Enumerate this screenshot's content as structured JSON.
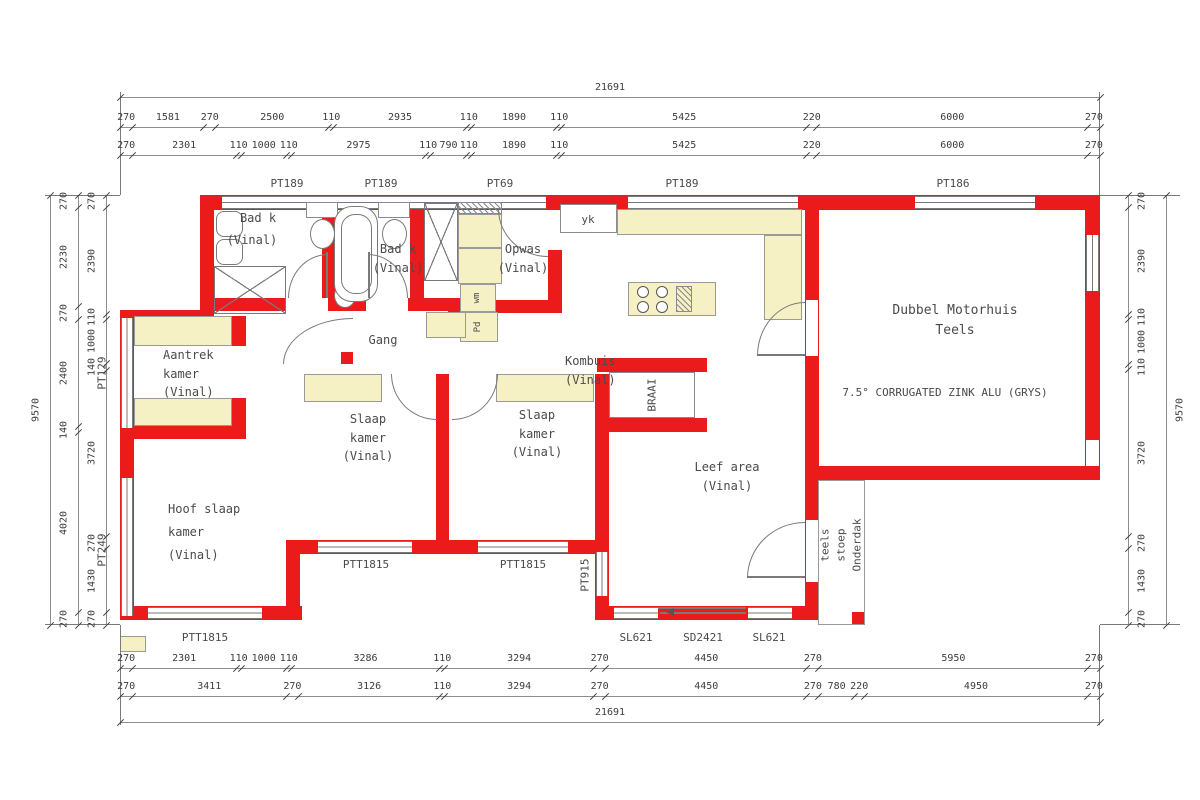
{
  "meta": {
    "drawing_type": "house floor plan"
  },
  "colors": {
    "wall": "#ec1b1b",
    "cupboard": "#f6f1c5",
    "line": "#7a7a7a",
    "text": "#4a4a4a"
  },
  "texts": {
    "garage_title": [
      "Dubbel Motorhuis",
      "Teels"
    ],
    "roof_note": "7.5° CORRUGATED ZINK ALU (GRYS)",
    "stoep": [
      "Onderdak",
      "stoep",
      "teels"
    ]
  },
  "dimensions": {
    "top": {
      "overall": 21691,
      "row_a": [
        270,
        1581,
        270,
        2500,
        110,
        2935,
        110,
        1890,
        110,
        5425,
        220,
        6000,
        270
      ],
      "row_b": [
        270,
        2301,
        110,
        1000,
        110,
        2975,
        110,
        790,
        110,
        1890,
        110,
        5425,
        220,
        6000,
        270
      ]
    },
    "bottom": {
      "row_a": [
        270,
        2301,
        110,
        1000,
        110,
        3286,
        110,
        3294,
        270,
        4450,
        270,
        5950,
        270
      ],
      "row_b": [
        270,
        3411,
        270,
        3126,
        110,
        3294,
        270,
        4450,
        270,
        780,
        220,
        4950,
        270
      ],
      "overall": 21691
    },
    "left": {
      "overall": 9570,
      "outer": [
        270,
        2230,
        270,
        2400,
        140,
        4020,
        270
      ],
      "inner": [
        270,
        2390,
        110,
        1000,
        140,
        3720,
        270,
        1430,
        270
      ]
    },
    "right": {
      "overall": 9570,
      "col": [
        270,
        2390,
        110,
        1000,
        110,
        3720,
        270,
        1430,
        270
      ]
    }
  },
  "labels": [
    {
      "n": "room-label-bad-k-1",
      "t": [
        "Bad k"
      ],
      "x": 258,
      "y": 209,
      "a": "c"
    },
    {
      "n": "room-label-bad-k-1-floor",
      "t": [
        "(Vinal)"
      ],
      "x": 252,
      "y": 231,
      "a": "c"
    },
    {
      "n": "room-label-bad-k-2",
      "t": [
        "Bad k",
        "(Vinal)"
      ],
      "x": 398,
      "y": 240,
      "a": "c"
    },
    {
      "n": "room-label-opwas",
      "t": [
        "Opwas",
        "(Vinal)"
      ],
      "x": 523,
      "y": 240,
      "a": "c"
    },
    {
      "n": "appliance-label-yk",
      "t": [
        "yk"
      ],
      "x": 588,
      "y": 211,
      "a": "c",
      "s": 11
    },
    {
      "n": "room-label-gang",
      "t": [
        "Gang"
      ],
      "x": 383,
      "y": 331,
      "a": "c"
    },
    {
      "n": "room-label-aantrek",
      "t": [
        "Aantrek",
        "kamer",
        "(Vinal)"
      ],
      "x": 163,
      "y": 346,
      "a": "l"
    },
    {
      "n": "room-label-hoof-slaap",
      "t": [
        "Hoof slaap",
        "kamer",
        "(Vinal)"
      ],
      "x": 168,
      "y": 498,
      "a": "l",
      "lh": 1.9
    },
    {
      "n": "room-label-slaap-2",
      "t": [
        "Slaap",
        "kamer",
        "(Vinal)"
      ],
      "x": 368,
      "y": 410,
      "a": "c"
    },
    {
      "n": "room-label-slaap-3",
      "t": [
        "Slaap",
        "kamer",
        "(Vinal)"
      ],
      "x": 537,
      "y": 406,
      "a": "c"
    },
    {
      "n": "room-label-kombuis",
      "t": [
        "Kombuis",
        "(Vinal)"
      ],
      "x": 565,
      "y": 352,
      "a": "l"
    },
    {
      "n": "room-label-leef-area",
      "t": [
        "Leef area",
        "(Vinal)"
      ],
      "x": 727,
      "y": 458,
      "a": "c"
    },
    {
      "n": "room-label-garage",
      "t": [
        "Dubbel Motorhuis",
        "Teels"
      ],
      "x": 955,
      "y": 301,
      "a": "c",
      "s": 13
    },
    {
      "n": "roof-note",
      "t": [
        "7.5° CORRUGATED ZINK ALU (GRYS)"
      ],
      "x": 945,
      "y": 384,
      "a": "c",
      "s": 11
    },
    {
      "n": "fixture-label-braai",
      "t": [
        "BRAAI"
      ],
      "x": 652,
      "y": 395,
      "r": 1,
      "s": 11
    },
    {
      "n": "appliance-label-wm",
      "t": [
        "wm"
      ],
      "x": 478,
      "y": 298,
      "r": 1,
      "s": 9
    },
    {
      "n": "appliance-label-pd",
      "t": [
        "Pd"
      ],
      "x": 479,
      "y": 327,
      "r": 1,
      "s": 9
    },
    {
      "n": "stoep-label-onderdak",
      "t": [
        "Onderdak"
      ],
      "x": 857,
      "y": 545,
      "r": 1,
      "s": 11
    },
    {
      "n": "stoep-label-stoep",
      "t": [
        "stoep"
      ],
      "x": 841,
      "y": 545,
      "r": 1,
      "s": 11
    },
    {
      "n": "stoep-label-teels",
      "t": [
        "teels"
      ],
      "x": 825,
      "y": 545,
      "r": 1,
      "s": 11
    },
    {
      "n": "window-label-pt189-1",
      "t": [
        "PT189"
      ],
      "x": 287,
      "y": 175,
      "a": "c",
      "s": 11
    },
    {
      "n": "window-label-pt189-2",
      "t": [
        "PT189"
      ],
      "x": 381,
      "y": 175,
      "a": "c",
      "s": 11
    },
    {
      "n": "window-label-pt69",
      "t": [
        "PT69"
      ],
      "x": 500,
      "y": 175,
      "a": "c",
      "s": 11
    },
    {
      "n": "window-label-pt189-3",
      "t": [
        "PT189"
      ],
      "x": 682,
      "y": 175,
      "a": "c",
      "s": 11
    },
    {
      "n": "window-label-pt186",
      "t": [
        "PT186"
      ],
      "x": 953,
      "y": 175,
      "a": "c",
      "s": 11
    },
    {
      "n": "window-label-pt129",
      "t": [
        "PT129"
      ],
      "x": 102,
      "y": 373,
      "r": 1,
      "s": 11
    },
    {
      "n": "window-label-pt249",
      "t": [
        "PT249"
      ],
      "x": 102,
      "y": 550,
      "r": 1,
      "s": 11
    },
    {
      "n": "window-label-pt915",
      "t": [
        "PT915"
      ],
      "x": 585,
      "y": 575,
      "r": 1,
      "s": 11
    },
    {
      "n": "window-label-ptt1815-1",
      "t": [
        "PTT1815"
      ],
      "x": 205,
      "y": 629,
      "a": "c",
      "s": 11
    },
    {
      "n": "window-label-ptt1815-2",
      "t": [
        "PTT1815"
      ],
      "x": 366,
      "y": 556,
      "a": "c",
      "s": 11
    },
    {
      "n": "window-label-ptt1815-3",
      "t": [
        "PTT1815"
      ],
      "x": 523,
      "y": 556,
      "a": "c",
      "s": 11
    },
    {
      "n": "door-label-sl621-1",
      "t": [
        "SL621"
      ],
      "x": 636,
      "y": 629,
      "a": "c",
      "s": 11
    },
    {
      "n": "door-label-sd2421",
      "t": [
        "SD2421"
      ],
      "x": 703,
      "y": 629,
      "a": "c",
      "s": 11
    },
    {
      "n": "door-label-sl621-2",
      "t": [
        "SL621"
      ],
      "x": 769,
      "y": 629,
      "a": "c",
      "s": 11
    }
  ],
  "geometry": {
    "walls": [
      [
        200,
        195,
        900,
        15
      ],
      [
        1085,
        195,
        15,
        285
      ],
      [
        818,
        466,
        282,
        14
      ],
      [
        805,
        195,
        14,
        271
      ],
      [
        805,
        466,
        14,
        154
      ],
      [
        595,
        606,
        224,
        14
      ],
      [
        595,
        540,
        14,
        80
      ],
      [
        286,
        540,
        323,
        14
      ],
      [
        286,
        540,
        14,
        80
      ],
      [
        120,
        606,
        182,
        14
      ],
      [
        120,
        310,
        14,
        310
      ],
      [
        200,
        195,
        14,
        115
      ],
      [
        120,
        310,
        94,
        14
      ],
      [
        200,
        298,
        262,
        13
      ],
      [
        322,
        195,
        13,
        103
      ],
      [
        410,
        195,
        14,
        103
      ],
      [
        448,
        300,
        114,
        13
      ],
      [
        548,
        250,
        14,
        63
      ],
      [
        436,
        374,
        13,
        166
      ],
      [
        595,
        374,
        14,
        166
      ],
      [
        597,
        358,
        110,
        14
      ],
      [
        597,
        418,
        110,
        14
      ],
      [
        232,
        316,
        14,
        30
      ],
      [
        232,
        398,
        14,
        28
      ],
      [
        134,
        426,
        112,
        13
      ],
      [
        341,
        352,
        12,
        12
      ],
      [
        852,
        612,
        13,
        13
      ]
    ],
    "gaps": [
      [
        806,
        300,
        12,
        56
      ],
      [
        806,
        520,
        12,
        62
      ],
      [
        1086,
        440,
        13,
        26
      ],
      [
        286,
        298,
        42,
        13
      ],
      [
        366,
        298,
        42,
        13
      ],
      [
        391,
        360,
        46,
        14
      ],
      [
        451,
        360,
        46,
        14
      ]
    ],
    "winh": [
      [
        222,
        196,
        130,
        13
      ],
      [
        338,
        196,
        142,
        13
      ],
      [
        468,
        196,
        78,
        13
      ],
      [
        628,
        196,
        170,
        13
      ],
      [
        915,
        196,
        120,
        13
      ],
      [
        148,
        607,
        114,
        12
      ],
      [
        318,
        541,
        94,
        12
      ],
      [
        478,
        541,
        90,
        12
      ],
      [
        614,
        607,
        44,
        12
      ],
      [
        748,
        607,
        44,
        12
      ]
    ],
    "winv": [
      [
        121,
        318,
        12,
        110
      ],
      [
        121,
        478,
        12,
        138
      ],
      [
        1086,
        235,
        13,
        56
      ],
      [
        596,
        552,
        12,
        44
      ]
    ],
    "cups": [
      [
        617,
        209,
        185,
        26
      ],
      [
        764,
        235,
        38,
        85
      ],
      [
        628,
        282,
        88,
        34
      ],
      [
        134,
        316,
        98,
        30
      ],
      [
        134,
        398,
        98,
        28
      ],
      [
        304,
        374,
        78,
        28
      ],
      [
        496,
        374,
        98,
        28
      ],
      [
        458,
        214,
        44,
        34
      ],
      [
        458,
        248,
        44,
        36
      ],
      [
        460,
        284,
        36,
        28
      ],
      [
        460,
        312,
        38,
        30
      ],
      [
        426,
        312,
        40,
        26
      ],
      [
        120,
        636,
        26,
        16
      ]
    ],
    "hatches": [
      [
        458,
        202,
        44,
        12
      ],
      [
        676,
        286,
        16,
        26
      ]
    ],
    "wboxes": [
      [
        560,
        204,
        57,
        29
      ],
      [
        609,
        372,
        86,
        46
      ],
      [
        306,
        202,
        32,
        16
      ],
      [
        378,
        202,
        32,
        16
      ]
    ],
    "oboxes": [
      [
        818,
        480,
        47,
        145
      ]
    ],
    "xboxes": [
      [
        214,
        266,
        72,
        48
      ],
      [
        424,
        203,
        34,
        78
      ]
    ],
    "ells": [
      [
        310,
        219,
        25,
        30
      ],
      [
        382,
        219,
        25,
        30
      ],
      [
        334,
        283,
        22,
        25
      ]
    ],
    "rrects": [
      [
        334,
        206,
        44,
        96,
        18,
        1
      ],
      [
        341,
        214,
        31,
        80,
        14,
        0
      ],
      [
        216,
        211,
        27,
        26,
        8,
        1
      ],
      [
        216,
        239,
        27,
        26,
        8,
        1
      ]
    ],
    "arcs": [
      [
        288,
        254,
        40,
        44,
        "tl"
      ],
      [
        368,
        254,
        40,
        44,
        "tr"
      ],
      [
        391,
        374,
        46,
        46,
        "bl"
      ],
      [
        452,
        374,
        46,
        46,
        "br"
      ],
      [
        283,
        318,
        70,
        46,
        "tl"
      ],
      [
        498,
        209,
        50,
        48,
        "bl"
      ],
      [
        757,
        302,
        48,
        54,
        "tl"
      ],
      [
        747,
        522,
        58,
        56,
        "tl"
      ]
    ],
    "dlines": [
      [
        326,
        252,
        2,
        46
      ],
      [
        368,
        252,
        2,
        46
      ],
      [
        757,
        354,
        48,
        2
      ],
      [
        747,
        576,
        58,
        2
      ],
      [
        658,
        607,
        88,
        2
      ],
      [
        660,
        612,
        86,
        2
      ],
      [
        120,
        92,
        1,
        103
      ],
      [
        1099,
        92,
        1,
        103
      ],
      [
        120,
        625,
        1,
        100
      ],
      [
        1099,
        625,
        1,
        100
      ],
      [
        45,
        195,
        75,
        1
      ],
      [
        45,
        624,
        75,
        1
      ],
      [
        1100,
        195,
        80,
        1
      ],
      [
        1100,
        624,
        80,
        1
      ]
    ],
    "tris": [
      [
        666,
        608
      ]
    ],
    "circles": [
      [
        637,
        286,
        12
      ],
      [
        637,
        301,
        12
      ],
      [
        656,
        286,
        12
      ],
      [
        656,
        301,
        12
      ]
    ]
  }
}
